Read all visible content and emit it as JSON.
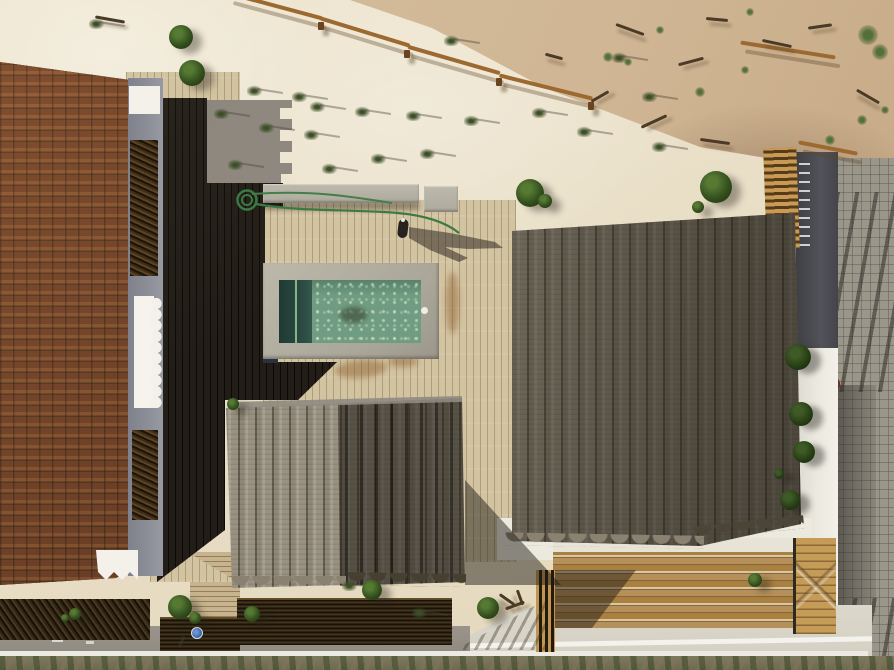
{
  "meta": {
    "type": "aerial-photograph",
    "title": "Aerial view of beach houses with thatched roofs and pool",
    "description": "Top-down drone photograph of a beachfront compound: a terracotta-tiled roof on the left, two reed-thatched roofs at center and right, a green swimming pool on a timber deck, white sand with dune grass above, reed pergolas and a cobblestone street below."
  },
  "colors": {
    "sandLit": "#e9dfc7",
    "dune": "#d0b795",
    "sandShadow": "#948d83",
    "tileBase": "#5f331e",
    "tileLight": "#7f4c2b",
    "greyWall": "#8b8e96",
    "white": "#f3f1ea",
    "deckDark": "#221e17",
    "deckLit": "#d2c3a1",
    "deckTop": "#c8b996",
    "bench": "#b6b2a5",
    "poolRim": "#aeaa9c",
    "waterMain": "#6f9c82",
    "waterDark": "#24423c",
    "waterLine": "#9fd09a",
    "thatchLit": "#a39b8a",
    "thatchDark": "#4e4839",
    "reedDark": "#31261f",
    "walkway": "#c7b48e",
    "road": "#95908a",
    "curb": "#ebe9e1",
    "scrub": "#7e7a60",
    "whitePad": "#d9d5c9",
    "stairWood": "#b1894f",
    "gate": "#c59b58",
    "fenceGold": "#b98e4e",
    "street": "#9a968a",
    "charcoal": "#4a4b50",
    "wallWhite": "#ebe8df",
    "bush": "#35511f",
    "hose": "#3c7a44",
    "signBlue": "#2f62ad",
    "redDisc": "#7c2d1f"
  },
  "scene": {
    "regions": [
      "sand-dune",
      "white-sand",
      "terracotta-roof",
      "shadow-deck",
      "sunlit-deck",
      "swimming-pool",
      "concrete-bench",
      "large-thatched-roof",
      "small-thatched-hut",
      "reed-pergolas",
      "boardwalk",
      "road",
      "cobblestone-street",
      "white-wall",
      "timber-stairs",
      "timber-gate",
      "slat-fence"
    ],
    "vegetation": {
      "tufts": [
        [
          97,
          23
        ],
        [
          255,
          90
        ],
        [
          222,
          113
        ],
        [
          267,
          127
        ],
        [
          236,
          164
        ],
        [
          300,
          96
        ],
        [
          318,
          106
        ],
        [
          312,
          134
        ],
        [
          330,
          168
        ],
        [
          363,
          111
        ],
        [
          414,
          115
        ],
        [
          379,
          158
        ],
        [
          428,
          153
        ],
        [
          452,
          40
        ],
        [
          472,
          120
        ],
        [
          540,
          112
        ],
        [
          585,
          131
        ],
        [
          660,
          146
        ],
        [
          620,
          57
        ],
        [
          350,
          585
        ],
        [
          420,
          612
        ],
        [
          650,
          96
        ]
      ],
      "bushes": [
        [
          181,
          37,
          12
        ],
        [
          192,
          73,
          13
        ],
        [
          530,
          193,
          14
        ],
        [
          545,
          201,
          7
        ],
        [
          716,
          187,
          16
        ],
        [
          698,
          207,
          6
        ],
        [
          233,
          404,
          6
        ],
        [
          372,
          590,
          10
        ],
        [
          180,
          607,
          12
        ],
        [
          252,
          614,
          8
        ],
        [
          488,
          608,
          11
        ],
        [
          755,
          580,
          7
        ],
        [
          75,
          614,
          6
        ],
        [
          65,
          618,
          4
        ],
        [
          195,
          618,
          6
        ]
      ],
      "sticks": [
        [
          615,
          28,
          30,
          20
        ],
        [
          678,
          60,
          26,
          -15
        ],
        [
          706,
          18,
          22,
          5
        ],
        [
          762,
          42,
          30,
          12
        ],
        [
          808,
          25,
          24,
          -8
        ],
        [
          855,
          95,
          26,
          30
        ],
        [
          640,
          120,
          28,
          -25
        ],
        [
          700,
          140,
          30,
          8
        ],
        [
          590,
          95,
          20,
          -30
        ],
        [
          545,
          55,
          18,
          15
        ],
        [
          95,
          18,
          30,
          10
        ],
        [
          498,
          598,
          18,
          35
        ],
        [
          505,
          604,
          20,
          -20
        ],
        [
          512,
          596,
          16,
          70
        ]
      ],
      "weeds": [
        [
          608,
          57,
          5
        ],
        [
          628,
          62,
          4
        ],
        [
          700,
          92,
          5
        ],
        [
          745,
          70,
          4
        ],
        [
          868,
          35,
          10
        ],
        [
          880,
          52,
          8
        ],
        [
          862,
          120,
          5
        ],
        [
          830,
          140,
          5
        ],
        [
          885,
          110,
          4
        ],
        [
          660,
          30,
          4
        ],
        [
          750,
          12,
          4
        ]
      ]
    }
  }
}
